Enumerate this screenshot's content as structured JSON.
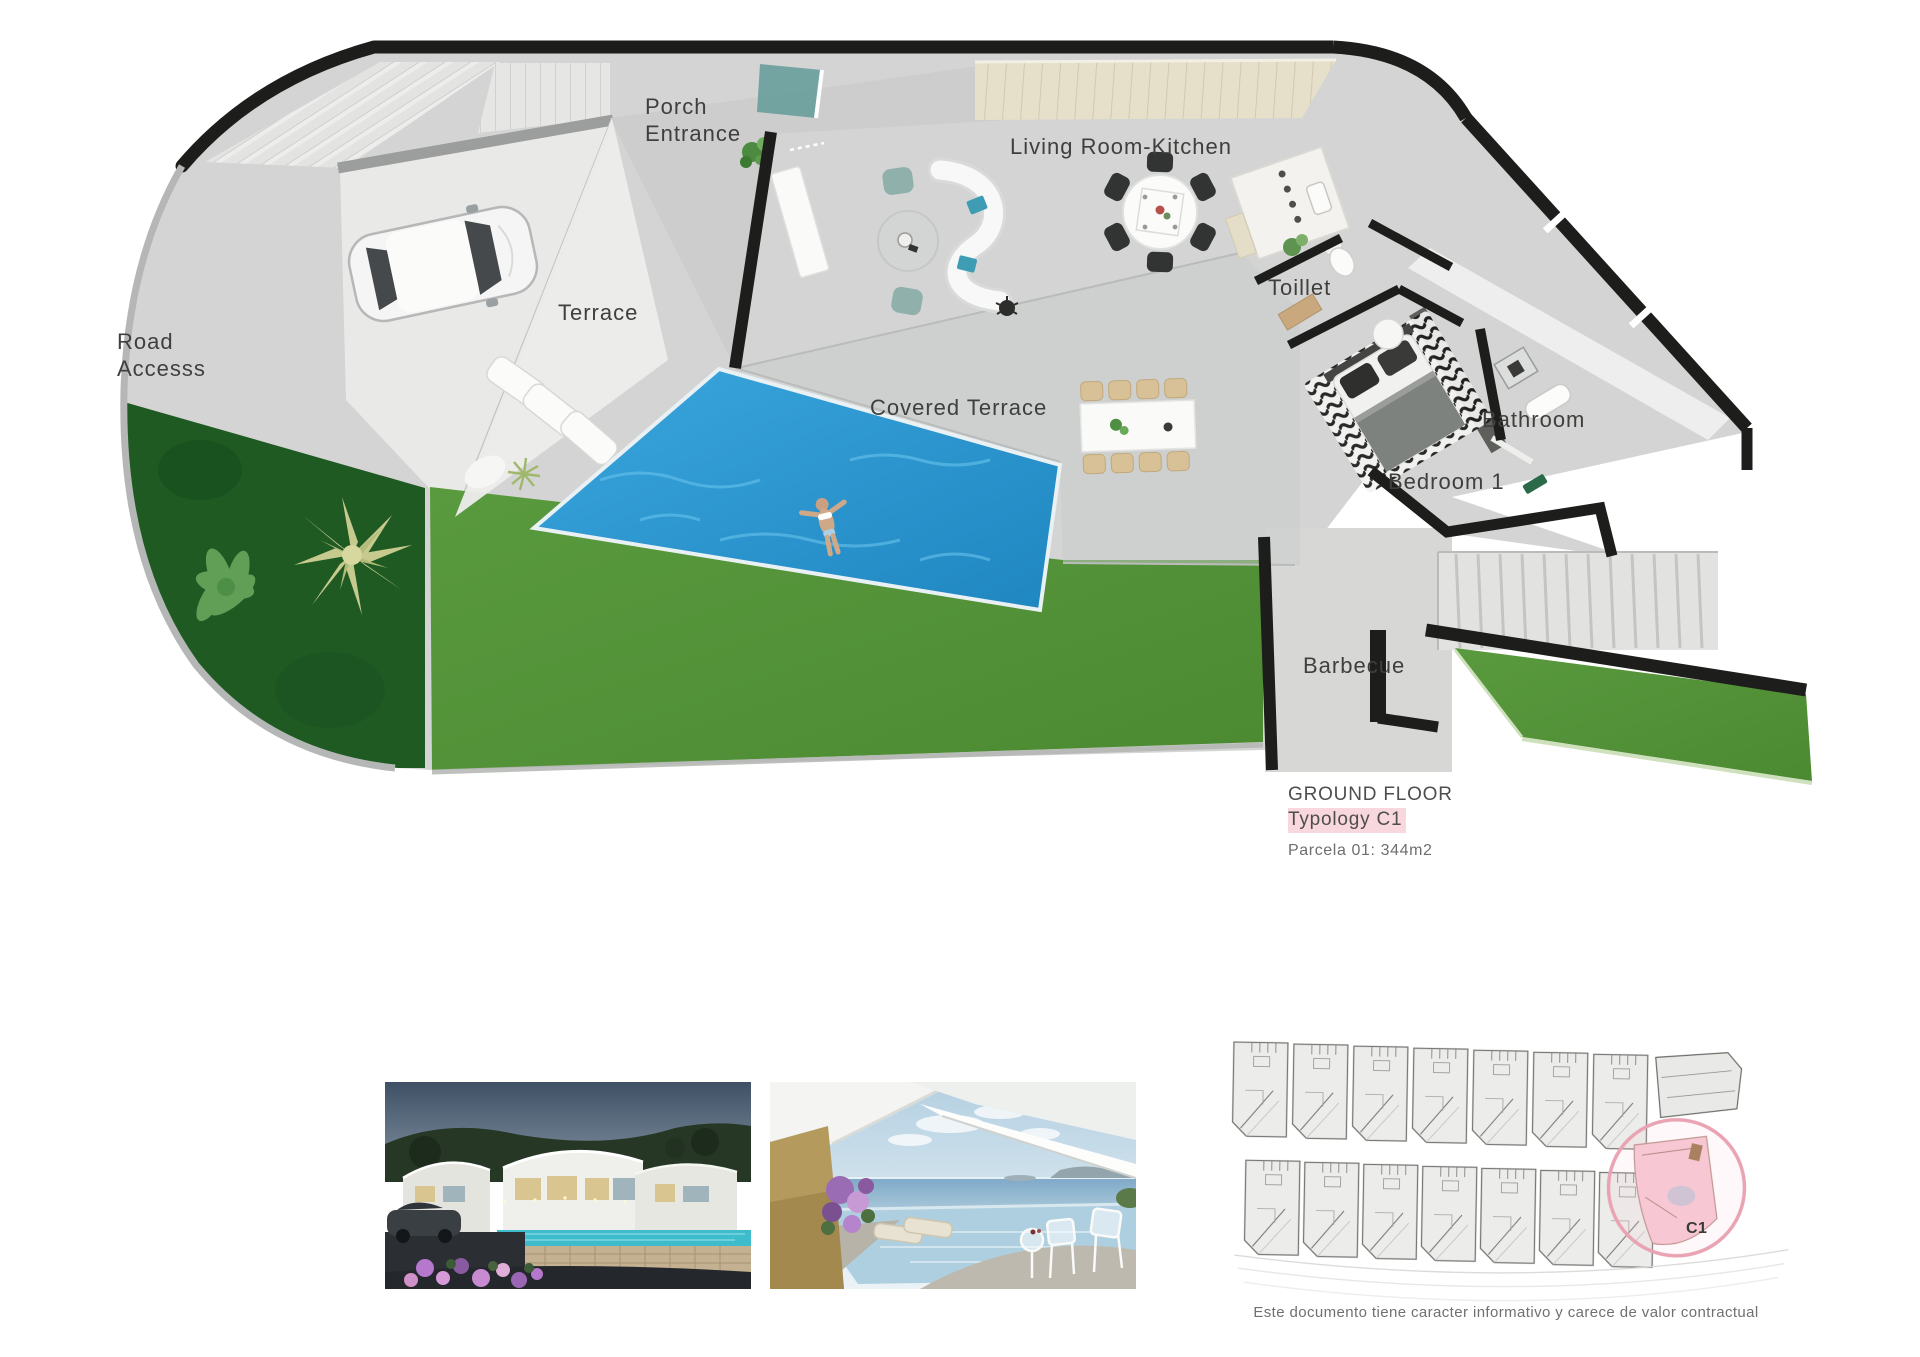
{
  "plan": {
    "labels": {
      "porch": {
        "line1": "Porch",
        "line2": "Entrance"
      },
      "living": "Living Room-Kitchen",
      "terrace": "Terrace",
      "road": {
        "line1": "Road",
        "line2": "Accesss"
      },
      "covered": "Covered Terrace",
      "toilet": "Toillet",
      "bathroom": "Bathroom",
      "bedroom": "Bedroom 1",
      "barbecue": "Barbecue"
    },
    "colors": {
      "lawn": "#549238",
      "garden": "#1f5a23",
      "pool": "#2f9cd4",
      "wall": "#1d1d1b",
      "highlight_pink": "#f8d7de",
      "site_circle_pink": "#e9a3b2"
    }
  },
  "title_block": {
    "line1": "GROUND FLOOR",
    "line2": "Typology C1",
    "line3": "Parcela 01: 344m2"
  },
  "site_plan": {
    "unit_label": "C1"
  },
  "images": {
    "photo1": "villa-exterior-dusk-render",
    "photo2": "covered-terrace-sea-view-render"
  },
  "footer": {
    "disclaimer": "Este documento tiene caracter informativo y carece de valor contractual"
  }
}
